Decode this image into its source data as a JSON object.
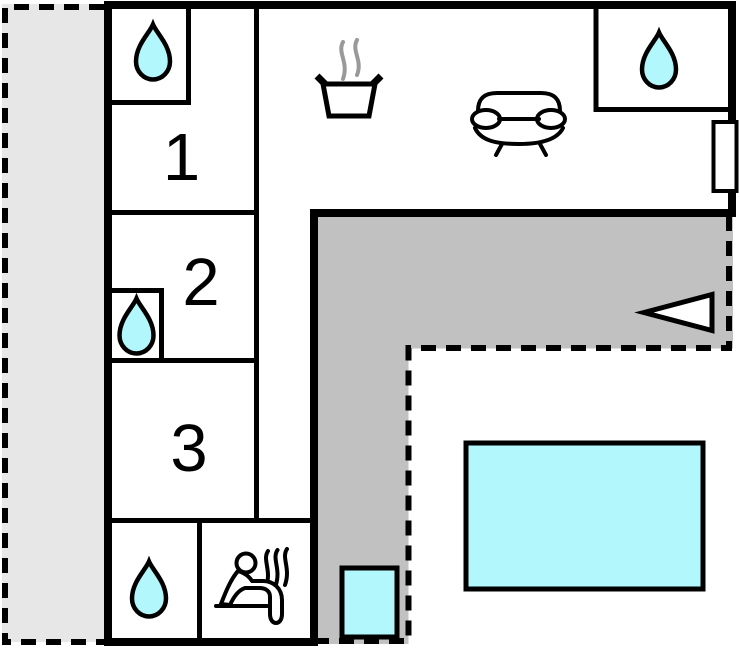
{
  "plan_title": "holiday-home-floor-plan",
  "rooms": [
    {
      "label": "1"
    },
    {
      "label": "2"
    },
    {
      "label": "3"
    }
  ],
  "colors": {
    "water": "#b2f7fb",
    "terrace": "#c1c1c1",
    "outdoor_light": "#e7e7e7",
    "wall": "#000000",
    "steam": "#999999"
  },
  "icons": {
    "bathroom": "water-drop-icon",
    "kitchen": "cooking-pot-icon",
    "living_room": "sofa-icon",
    "sauna": "sauna-person-icon",
    "entrance": "entrance-arrow-icon",
    "window": "window-marker",
    "pool": "pool-rect",
    "hot_tub": "hot-tub-rect"
  }
}
